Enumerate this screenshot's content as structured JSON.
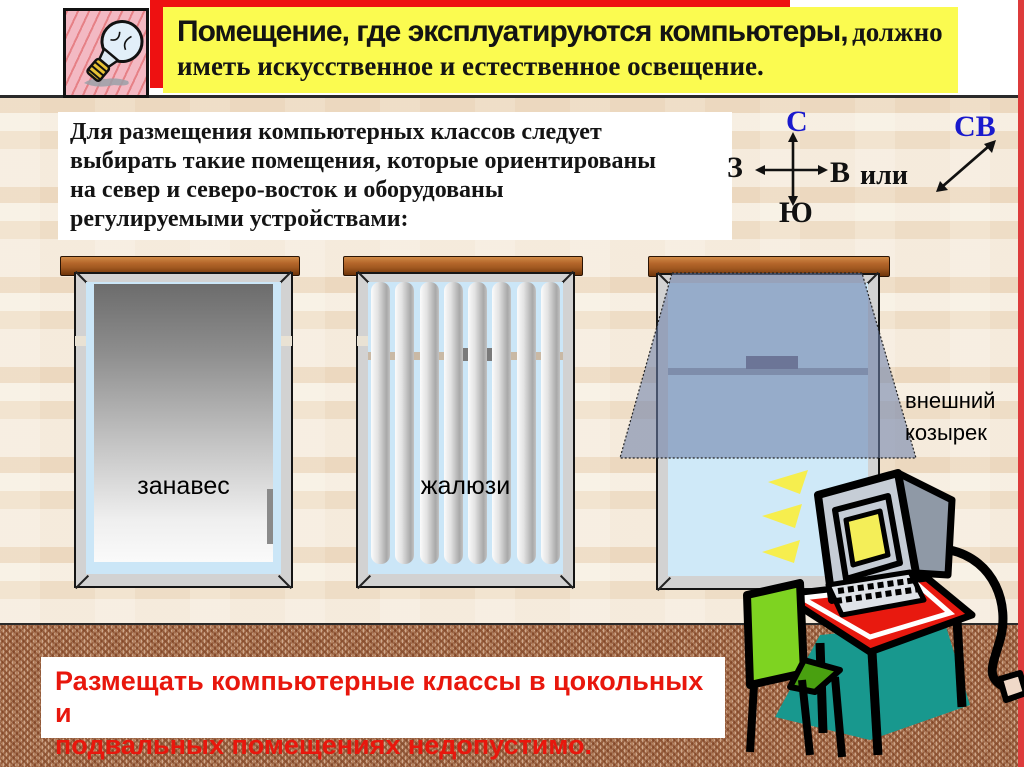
{
  "banner": {
    "line1_sans": "Помещение, где эксплуатируются компьютеры,",
    "line1_serif": "должно",
    "line2": "иметь искусственное и естественное освещение.",
    "background_color": "#fbfb50",
    "backdrop_color": "#ee1111"
  },
  "info": {
    "lines": [
      "Для размещения компьютерных классов следует",
      "выбирать такие помещения, которые ориентированы",
      "на север и северо-восток и оборудованы",
      "регулируемыми устройствами:"
    ]
  },
  "compass": {
    "north": "С",
    "south": "Ю",
    "west": "З",
    "east": "В",
    "or_label": "или",
    "northeast": "СВ",
    "letter_color_ns": "#1a1acd",
    "letter_color_default": "#111111"
  },
  "windows": {
    "curtain_label": "занавес",
    "blinds_label": "жалюзи",
    "canopy_label": "внешний козырек"
  },
  "warning": {
    "lines": [
      "Размещать компьютерные классы в цокольных и",
      "подвальных  помещениях недопустимо."
    ],
    "text_color": "#e8170d"
  },
  "icons": {
    "lightbulb": "lightbulb-icon",
    "computer_desk": "computer-desk-illustration",
    "compass_cross": "compass-cross-arrows",
    "northeast_arrow": "northeast-diagonal-arrow",
    "light_rays": "light-rays-icon"
  },
  "colors": {
    "wall": "#f4ead9",
    "floor": "#b5825f",
    "right_border_red": "#dd3b3b",
    "cornice_brown": "#a05820",
    "glass_blue": "#cbe6f7",
    "canopy_blue": "rgba(108,128,168,0.58)",
    "desk_red": "#e8190f",
    "chair_green": "#7ed321",
    "screen_yellow": "#f4ee58",
    "shadow_teal": "#18988e"
  }
}
